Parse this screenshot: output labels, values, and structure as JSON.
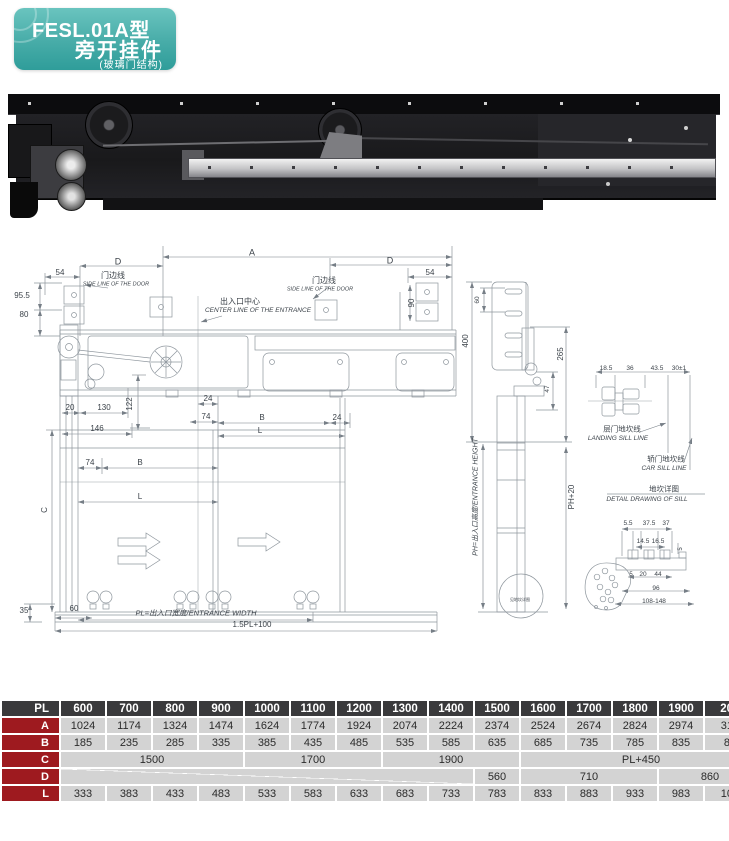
{
  "header": {
    "model": "FESL.01A型",
    "product": "旁开挂件",
    "subtitle": "(玻璃门结构)",
    "accent_color": "#47aca8"
  },
  "colors": {
    "table_header_bg": "#3a3a3c",
    "table_row_label_bg": "#9e1a1f",
    "table_cell_bg": "#d3d3d3",
    "drawing_line": "#8e969d"
  },
  "drawing": {
    "labels": [
      {
        "t": "A",
        "x": 252,
        "y": 15,
        "fs": 9,
        "r": 0,
        "i": 0
      },
      {
        "t": "D",
        "x": 118,
        "y": 24,
        "fs": 9,
        "r": 0,
        "i": 0
      },
      {
        "t": "54",
        "x": 60,
        "y": 35,
        "fs": 8,
        "r": 0,
        "i": 0
      },
      {
        "t": "门边线",
        "x": 113,
        "y": 38,
        "fs": 8,
        "r": 0,
        "i": 0
      },
      {
        "t": "SIDE LINE OF THE DOOR",
        "x": 116,
        "y": 47,
        "fs": 5.5,
        "r": 0,
        "i": 1
      },
      {
        "t": "95.5",
        "x": 22,
        "y": 58,
        "fs": 8,
        "r": 0,
        "i": 0
      },
      {
        "t": "80",
        "x": 24,
        "y": 77,
        "fs": 8,
        "r": 0,
        "i": 0
      },
      {
        "t": "出入口中心",
        "x": 240,
        "y": 64,
        "fs": 8,
        "r": 0,
        "i": 0
      },
      {
        "t": "CENTER LINE OF THE ENTRANCE",
        "x": 258,
        "y": 73,
        "fs": 6.5,
        "r": 0,
        "i": 1
      },
      {
        "t": "门边线",
        "x": 324,
        "y": 43,
        "fs": 8,
        "r": 0,
        "i": 0
      },
      {
        "t": "SIDE LINE OF THE DOOR",
        "x": 320,
        "y": 52,
        "fs": 5.5,
        "r": 0,
        "i": 1
      },
      {
        "t": "D",
        "x": 390,
        "y": 23,
        "fs": 9,
        "r": 0,
        "i": 0
      },
      {
        "t": "54",
        "x": 430,
        "y": 35,
        "fs": 8,
        "r": 0,
        "i": 0
      },
      {
        "t": "90",
        "x": 412,
        "y": 65,
        "fs": 8,
        "r": -90,
        "i": 0
      },
      {
        "t": "20",
        "x": 70,
        "y": 170,
        "fs": 8,
        "r": 0,
        "i": 0
      },
      {
        "t": "130",
        "x": 104,
        "y": 170,
        "fs": 8,
        "r": 0,
        "i": 0
      },
      {
        "t": "122",
        "x": 130,
        "y": 166,
        "fs": 8,
        "r": -90,
        "i": 0
      },
      {
        "t": "24",
        "x": 208,
        "y": 161,
        "fs": 8,
        "r": 0,
        "i": 0
      },
      {
        "t": "74",
        "x": 206,
        "y": 179,
        "fs": 8,
        "r": 0,
        "i": 0
      },
      {
        "t": "B",
        "x": 262,
        "y": 180,
        "fs": 8,
        "r": 0,
        "i": 0
      },
      {
        "t": "24",
        "x": 337,
        "y": 180,
        "fs": 8,
        "r": 0,
        "i": 0
      },
      {
        "t": "L",
        "x": 260,
        "y": 193,
        "fs": 8,
        "r": 0,
        "i": 0
      },
      {
        "t": "146",
        "x": 97,
        "y": 191,
        "fs": 8,
        "r": 0,
        "i": 0
      },
      {
        "t": "74",
        "x": 90,
        "y": 225,
        "fs": 8,
        "r": 0,
        "i": 0
      },
      {
        "t": "B",
        "x": 140,
        "y": 225,
        "fs": 8,
        "r": 0,
        "i": 0
      },
      {
        "t": "L",
        "x": 140,
        "y": 259,
        "fs": 8,
        "r": 0,
        "i": 0
      },
      {
        "t": "C",
        "x": 45,
        "y": 272,
        "fs": 8,
        "r": -90,
        "i": 0
      },
      {
        "t": "35",
        "x": 24,
        "y": 373,
        "fs": 8,
        "r": 0,
        "i": 0
      },
      {
        "t": "60",
        "x": 74,
        "y": 371,
        "fs": 8,
        "r": 0,
        "i": 0
      },
      {
        "t": "PL=出入口宽度/ENTRANCE WIDTH",
        "x": 196,
        "y": 375,
        "fs": 7.5,
        "r": 0,
        "i": 1
      },
      {
        "t": "1.5PL+100",
        "x": 252,
        "y": 387,
        "fs": 8,
        "r": 0,
        "i": 0
      },
      {
        "t": "60",
        "x": 478,
        "y": 62,
        "fs": 6.5,
        "r": -90,
        "i": 0
      },
      {
        "t": "400",
        "x": 466,
        "y": 103,
        "fs": 8,
        "r": -90,
        "i": 0
      },
      {
        "t": "265",
        "x": 561,
        "y": 116,
        "fs": 8,
        "r": -90,
        "i": 0
      },
      {
        "t": "47",
        "x": 548,
        "y": 151,
        "fs": 6.5,
        "r": -90,
        "i": 0
      },
      {
        "t": "PH=出入口高度/ENTRANCE HEIGHT",
        "x": 476,
        "y": 259,
        "fs": 7,
        "r": -90,
        "i": 1
      },
      {
        "t": "PH+20",
        "x": 572,
        "y": 259,
        "fs": 8,
        "r": -90,
        "i": 0
      },
      {
        "t": "18.5",
        "x": 606,
        "y": 131,
        "fs": 6.5,
        "r": 0,
        "i": 0
      },
      {
        "t": "36",
        "x": 630,
        "y": 131,
        "fs": 6.5,
        "r": 0,
        "i": 0
      },
      {
        "t": "43.5",
        "x": 657,
        "y": 131,
        "fs": 6.5,
        "r": 0,
        "i": 0
      },
      {
        "t": "30±1",
        "x": 679,
        "y": 131,
        "fs": 6.5,
        "r": 0,
        "i": 0
      },
      {
        "t": "层门地坎线",
        "x": 622,
        "y": 191,
        "fs": 7.5,
        "r": 0,
        "i": 0
      },
      {
        "t": "LANDING SILL LINE",
        "x": 618,
        "y": 201,
        "fs": 6.5,
        "r": 0,
        "i": 1
      },
      {
        "t": "轿门地坎线",
        "x": 666,
        "y": 221,
        "fs": 7.5,
        "r": 0,
        "i": 0
      },
      {
        "t": "CAR SILL LINE",
        "x": 664,
        "y": 231,
        "fs": 6.5,
        "r": 0,
        "i": 1
      },
      {
        "t": "地坎详图",
        "x": 664,
        "y": 251,
        "fs": 7.5,
        "r": 0,
        "i": 0
      },
      {
        "t": "DETAIL DRAWING OF SILL",
        "x": 647,
        "y": 262,
        "fs": 6.5,
        "r": 0,
        "i": 1
      },
      {
        "t": "5.5",
        "x": 628,
        "y": 286,
        "fs": 6.5,
        "r": 0,
        "i": 0
      },
      {
        "t": "37.5",
        "x": 649,
        "y": 286,
        "fs": 6.5,
        "r": 0,
        "i": 0
      },
      {
        "t": "37",
        "x": 666,
        "y": 286,
        "fs": 6.5,
        "r": 0,
        "i": 0
      },
      {
        "t": "14.5",
        "x": 643,
        "y": 304,
        "fs": 6.5,
        "r": 0,
        "i": 0
      },
      {
        "t": "16.5",
        "x": 658,
        "y": 304,
        "fs": 6.5,
        "r": 0,
        "i": 0
      },
      {
        "t": "5",
        "x": 681,
        "y": 311,
        "fs": 6,
        "r": -90,
        "i": 0
      },
      {
        "t": "5",
        "x": 631,
        "y": 337,
        "fs": 6,
        "r": 0,
        "i": 0
      },
      {
        "t": "20",
        "x": 643,
        "y": 337,
        "fs": 6.5,
        "r": 0,
        "i": 0
      },
      {
        "t": "44",
        "x": 658,
        "y": 337,
        "fs": 6.5,
        "r": 0,
        "i": 0
      },
      {
        "t": "96",
        "x": 656,
        "y": 351,
        "fs": 6.5,
        "r": 0,
        "i": 0
      },
      {
        "t": "108-148",
        "x": 654,
        "y": 364,
        "fs": 6.5,
        "r": 0,
        "i": 0
      },
      {
        "t": "见地坎详图",
        "x": 520,
        "y": 362,
        "fs": 4,
        "r": 0,
        "i": 0
      }
    ]
  },
  "table": {
    "col_header": "PL",
    "columns": [
      "600",
      "700",
      "800",
      "900",
      "1000",
      "1100",
      "1200",
      "1300",
      "1400",
      "1500",
      "1600",
      "1700",
      "1800",
      "1900",
      "2000"
    ],
    "rows": [
      {
        "label": "A",
        "cells": [
          {
            "t": "1024"
          },
          {
            "t": "1174"
          },
          {
            "t": "1324"
          },
          {
            "t": "1474"
          },
          {
            "t": "1624"
          },
          {
            "t": "1774"
          },
          {
            "t": "1924"
          },
          {
            "t": "2074"
          },
          {
            "t": "2224"
          },
          {
            "t": "2374"
          },
          {
            "t": "2524"
          },
          {
            "t": "2674"
          },
          {
            "t": "2824"
          },
          {
            "t": "2974"
          },
          {
            "t": "3124"
          }
        ]
      },
      {
        "label": "B",
        "cells": [
          {
            "t": "185"
          },
          {
            "t": "235"
          },
          {
            "t": "285"
          },
          {
            "t": "335"
          },
          {
            "t": "385"
          },
          {
            "t": "435"
          },
          {
            "t": "485"
          },
          {
            "t": "535"
          },
          {
            "t": "585"
          },
          {
            "t": "635"
          },
          {
            "t": "685"
          },
          {
            "t": "735"
          },
          {
            "t": "785"
          },
          {
            "t": "835"
          },
          {
            "t": "885"
          }
        ]
      },
      {
        "label": "C",
        "cells": [
          {
            "t": "1500",
            "span": 4
          },
          {
            "t": "1700",
            "span": 3
          },
          {
            "t": "1900",
            "span": 3
          },
          {
            "t": "PL+450",
            "span": 5
          }
        ]
      },
      {
        "label": "D",
        "cells": [
          {
            "t": "",
            "span": 9,
            "diag": true
          },
          {
            "t": "560",
            "span": 1
          },
          {
            "t": "710",
            "span": 3
          },
          {
            "t": "860",
            "span": 2
          }
        ]
      },
      {
        "label": "L",
        "cells": [
          {
            "t": "333"
          },
          {
            "t": "383"
          },
          {
            "t": "433"
          },
          {
            "t": "483"
          },
          {
            "t": "533"
          },
          {
            "t": "583"
          },
          {
            "t": "633"
          },
          {
            "t": "683"
          },
          {
            "t": "733"
          },
          {
            "t": "783"
          },
          {
            "t": "833"
          },
          {
            "t": "883"
          },
          {
            "t": "933"
          },
          {
            "t": "983"
          },
          {
            "t": "1033"
          }
        ]
      }
    ]
  }
}
